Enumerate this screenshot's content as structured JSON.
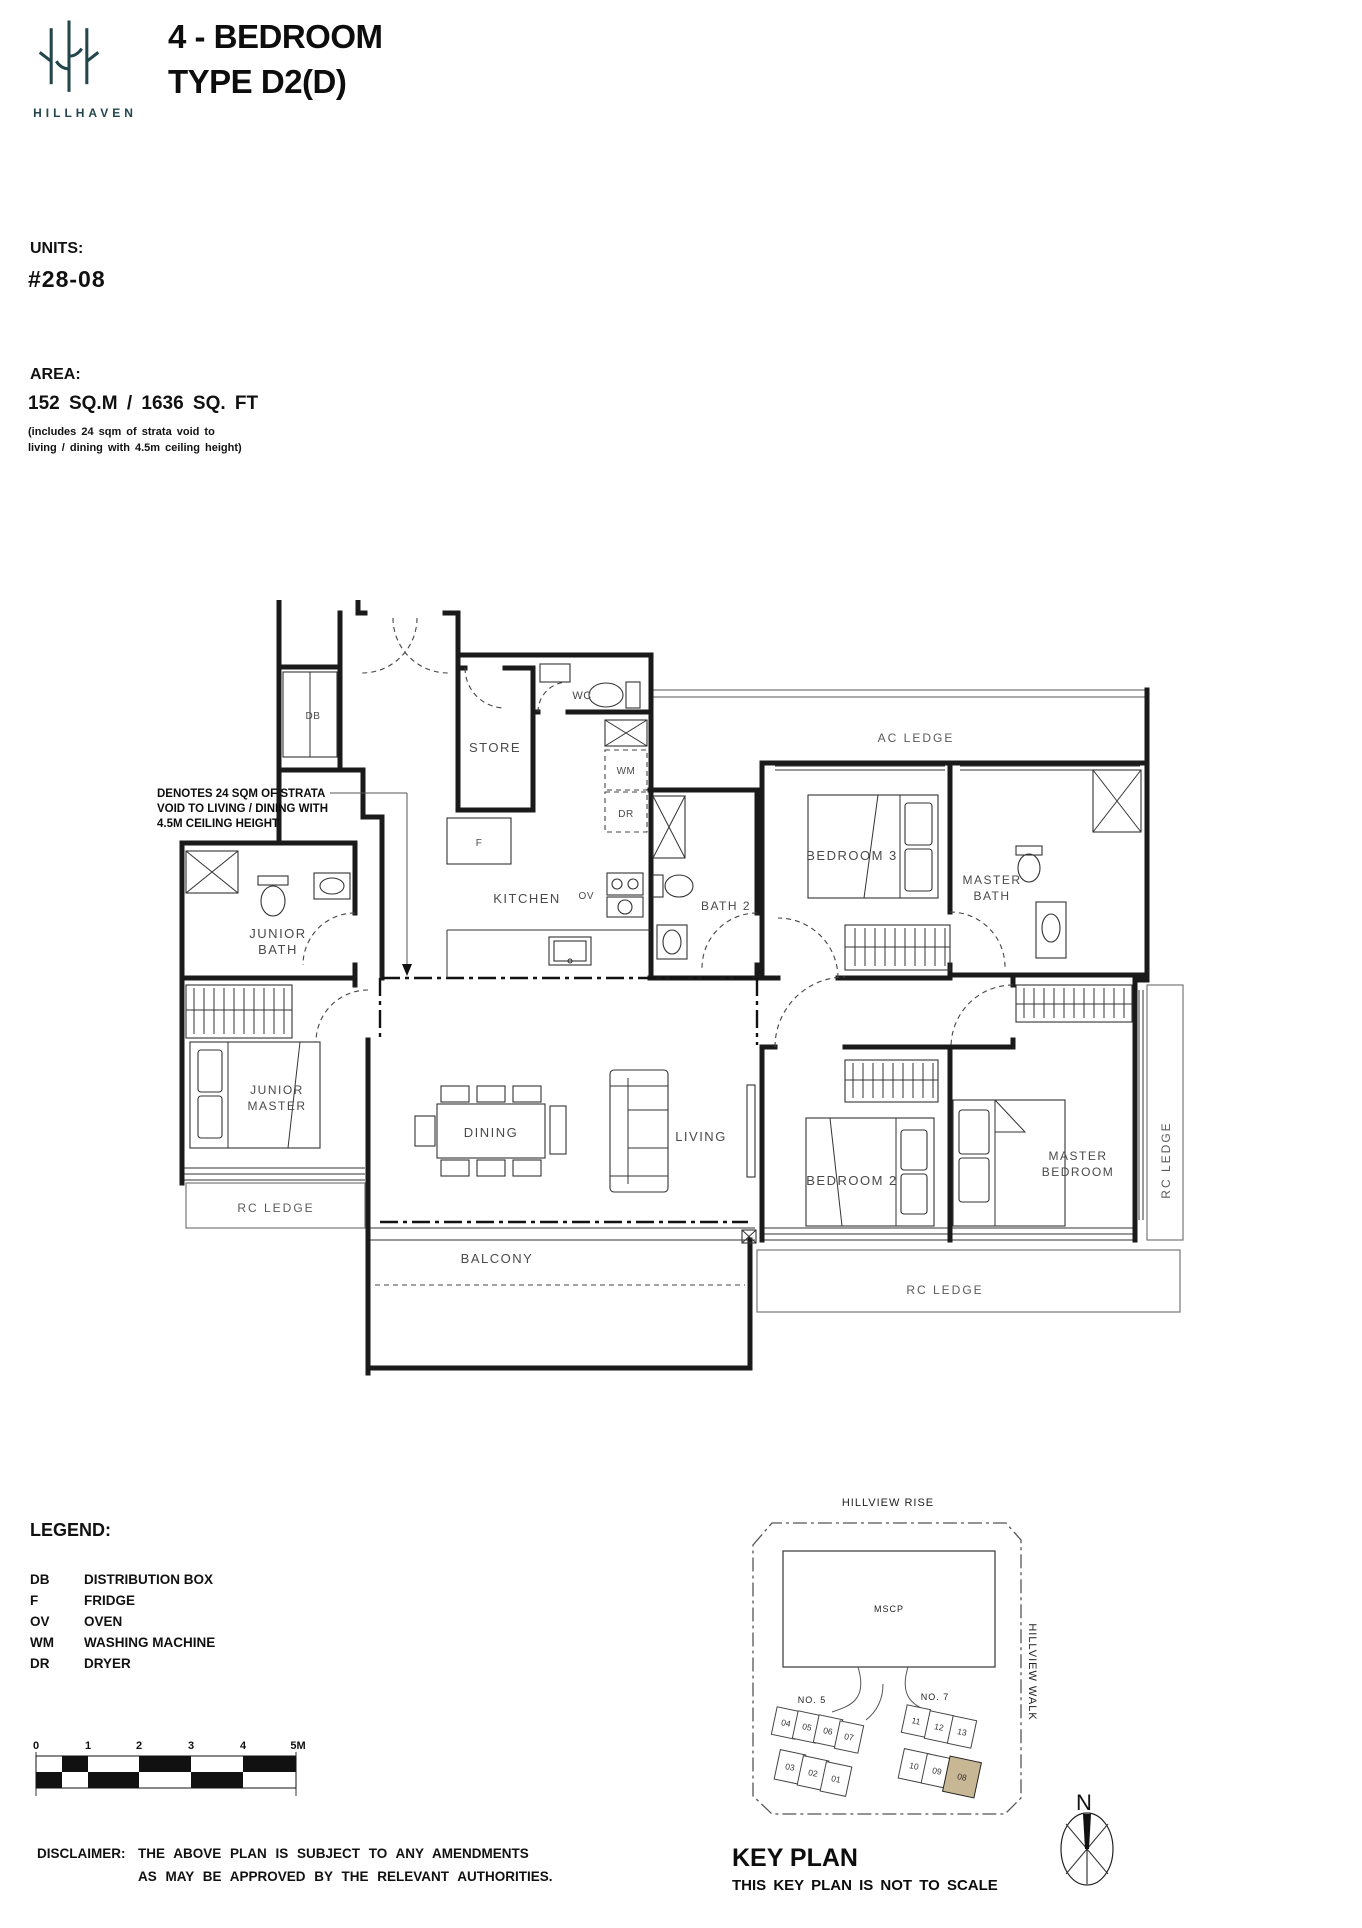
{
  "header": {
    "logo_text": "HILLHAVEN",
    "title_line1": "4 - BEDROOM",
    "title_line2": "TYPE D2(D)"
  },
  "unit_info": {
    "units_label": "UNITS:",
    "unit_number": "#28-08",
    "area_label": "AREA:",
    "area_value": "152 SQ.M / 1636 SQ. FT",
    "area_note1": "(includes 24 sqm of strata void to",
    "area_note2": "living / dining with 4.5m ceiling height)"
  },
  "floorplan": {
    "annotation1": "DENOTES 24 SQM OF STRATA",
    "annotation2": "VOID TO LIVING / DINING WITH",
    "annotation3": "4.5M CEILING HEIGHT",
    "labels": {
      "db": "DB",
      "store": "STORE",
      "wc": "WC",
      "wm": "WM",
      "dr": "DR",
      "fridge": "F",
      "oven": "OV",
      "kitchen": "KITCHEN",
      "bath2": "BATH 2",
      "bedroom3": "BEDROOM 3",
      "master_bath1": "MASTER",
      "master_bath2": "BATH",
      "junior_bath1": "JUNIOR",
      "junior_bath2": "BATH",
      "junior_master1": "JUNIOR",
      "junior_master2": "MASTER",
      "dining": "DINING",
      "living": "LIVING",
      "bedroom2": "BEDROOM 2",
      "master_bedroom1": "MASTER",
      "master_bedroom2": "BEDROOM",
      "balcony": "BALCONY",
      "ac_ledge": "AC LEDGE",
      "rc_ledge_left": "RC LEDGE",
      "rc_ledge_right": "RC LEDGE",
      "rc_ledge_bottom": "RC LEDGE"
    }
  },
  "legend": {
    "title": "LEGEND:",
    "items": [
      {
        "abbr": "DB",
        "desc": "DISTRIBUTION BOX"
      },
      {
        "abbr": "F",
        "desc": "FRIDGE"
      },
      {
        "abbr": "OV",
        "desc": "OVEN"
      },
      {
        "abbr": "WM",
        "desc": "WASHING MACHINE"
      },
      {
        "abbr": "DR",
        "desc": "DRYER"
      }
    ]
  },
  "scale_bar": {
    "labels": [
      "0",
      "1",
      "2",
      "3",
      "4",
      "5M"
    ]
  },
  "disclaimer": {
    "label": "DISCLAIMER:",
    "line1": "THE ABOVE PLAN IS SUBJECT TO ANY AMENDMENTS",
    "line2": "AS MAY BE APPROVED BY THE RELEVANT AUTHORITIES."
  },
  "key_plan": {
    "title": "KEY PLAN",
    "subtitle": "THIS KEY PLAN IS NOT TO SCALE",
    "road_top": "HILLVIEW RISE",
    "road_right": "HILLVIEW WALK",
    "mscp_label": "MSCP",
    "block5_label": "NO. 5",
    "block7_label": "NO. 7",
    "block5_units": [
      "04",
      "05",
      "06",
      "07",
      "03",
      "02",
      "01"
    ],
    "block7_units": [
      "11",
      "12",
      "13",
      "10",
      "09",
      "08"
    ],
    "highlighted_unit": "08",
    "highlight_color": "#c8b795",
    "north_label": "N"
  }
}
